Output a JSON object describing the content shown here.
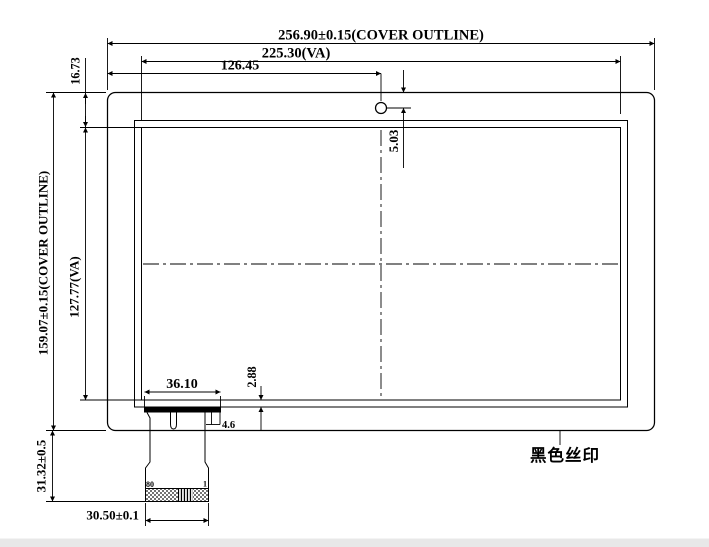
{
  "drawing": {
    "top_dims": {
      "cover_width": "256.90±0.15(COVER OUTLINE)",
      "va_width": "225.30(VA)",
      "hole_x": "126.45",
      "hole_y": "5.03"
    },
    "left_dims": {
      "cover_height": "159.07±0.15(COVER OUTLINE)",
      "top_margin": "16.73",
      "va_height": "127.77(VA)",
      "tail_length": "31.32±0.5"
    },
    "bottom_dims": {
      "bonding_width": "36.10",
      "edge_gap": "2.88",
      "step_width": "4.6",
      "connector_width": "30.50±0.1"
    },
    "annotations": {
      "silkscreen": "黑色丝印",
      "pin_start": "80",
      "pin_end": "1"
    },
    "colors": {
      "line": "#000000",
      "background": "#ffffff",
      "footer_strip": "#e8e8e8"
    }
  }
}
